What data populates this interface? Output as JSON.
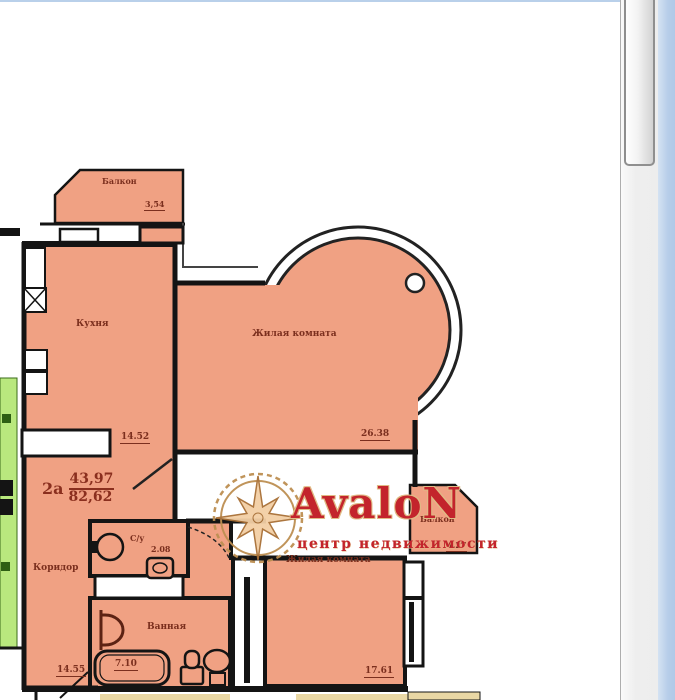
{
  "viewer": {
    "scrollbar": {
      "orientation": "vertical",
      "thumb_position": "top"
    }
  },
  "watermark": {
    "brand": "AvaloN",
    "tagline": "центр недвижимости"
  },
  "plan": {
    "unit": {
      "number": "2а",
      "living_area": "43,97",
      "total_area": "82,62"
    },
    "rooms": [
      {
        "id": "balcony-top",
        "name": "Балкон",
        "area": "3,54"
      },
      {
        "id": "kitchen",
        "name": "Кухня",
        "area": "14.52"
      },
      {
        "id": "living-room-1",
        "name": "Жилая комната",
        "area": "26.38"
      },
      {
        "id": "wc",
        "name": "С/у",
        "area": "2.08"
      },
      {
        "id": "corridor",
        "name": "Коридор",
        "area": "14.55"
      },
      {
        "id": "bathroom",
        "name": "Ванная",
        "area": "7.10"
      },
      {
        "id": "living-room-2",
        "name": "Жилая комната",
        "area": "17.61"
      },
      {
        "id": "balcony-right",
        "name": "Балкон",
        "area": "4.27"
      }
    ]
  },
  "colors": {
    "room_fill": "#f0a183",
    "wall": "#141414",
    "adjacent_apartment_fill": "#b9e87e",
    "lower_unit_fill": "#e9d7a4",
    "label_text": "#7b2f1e",
    "watermark_red": "#c3242c",
    "window_edge_blue": "#b6cde9"
  }
}
